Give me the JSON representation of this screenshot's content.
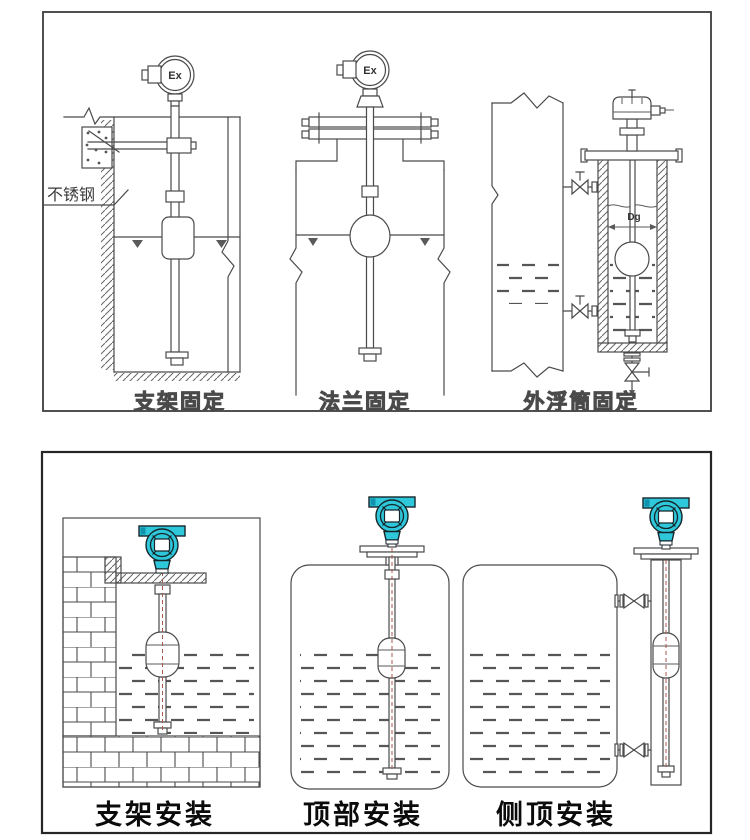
{
  "colors": {
    "line_gray": "#4a4a4a",
    "caption_black": "#0b0b0b",
    "transmitter_teal": "#2fc7da",
    "transmitter_teal_dark": "#0f93ad",
    "axis_red": "#a8574e"
  },
  "top_panel": {
    "captions": [
      {
        "id": "bracket_fix",
        "text": "支架固定"
      },
      {
        "id": "flange_fix",
        "text": "法兰固定"
      },
      {
        "id": "chamber_fix",
        "text": "外浮筒固定"
      }
    ],
    "annotations": {
      "stainless_steel": "不锈钢",
      "ex1": "Ex",
      "ex2": "Ex",
      "dg": "Dg"
    }
  },
  "bottom_panel": {
    "captions": [
      {
        "id": "bracket_install",
        "text": "支架安装"
      },
      {
        "id": "top_install",
        "text": "顶部安装"
      },
      {
        "id": "side_top_install",
        "text": "侧顶安装"
      }
    ]
  }
}
